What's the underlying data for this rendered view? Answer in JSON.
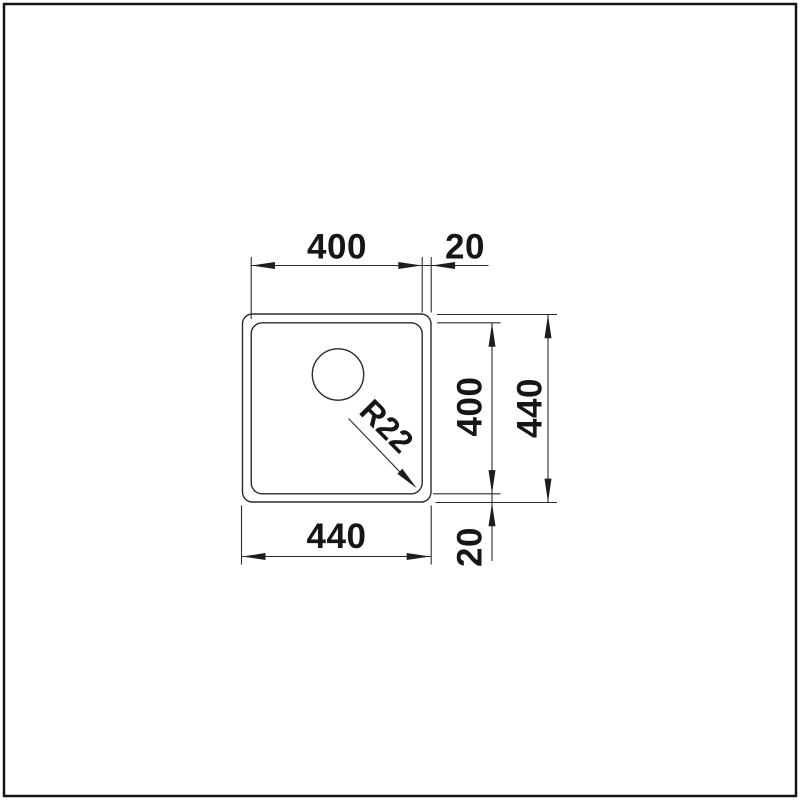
{
  "drawing": {
    "type": "technical dimension drawing",
    "view": "sink bowl top view",
    "units": "mm",
    "labels": {
      "inner_width": "400",
      "right_edge_offset": "20",
      "inner_height": "400",
      "outer_height": "440",
      "outer_width": "440",
      "bottom_edge_offset": "20",
      "corner_radius": "R22"
    },
    "colors": {
      "background": "#ffffff",
      "frame": "#141414",
      "line": "#2b2b2b",
      "text": "#161616"
    }
  }
}
